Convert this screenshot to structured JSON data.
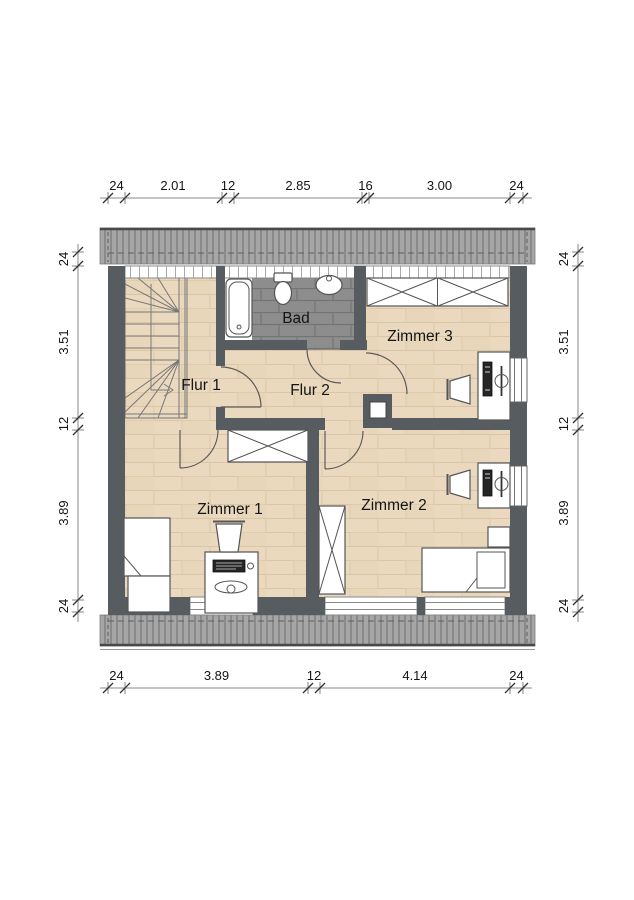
{
  "plan": {
    "rooms": [
      {
        "id": "bad",
        "label": "Bad"
      },
      {
        "id": "flur-1",
        "label": "Flur 1"
      },
      {
        "id": "flur-2",
        "label": "Flur 2"
      },
      {
        "id": "zimmer-3",
        "label": "Zimmer 3"
      },
      {
        "id": "zimmer-1",
        "label": "Zimmer 1"
      },
      {
        "id": "zimmer-2",
        "label": "Zimmer 2"
      }
    ],
    "dimensions": {
      "top": [
        "24",
        "2.01",
        "12",
        "2.85",
        "16",
        "3.00",
        "24"
      ],
      "bottom": [
        "24",
        "3.89",
        "12",
        "4.14",
        "24"
      ],
      "left": [
        "24",
        "3.51",
        "12",
        "3.89",
        "24"
      ],
      "right": [
        "24",
        "3.51",
        "12",
        "3.89",
        "24"
      ]
    }
  },
  "colors": {
    "wall": "#575c60",
    "wood_floor": "#ead9bf",
    "tile_floor": "#8d8d8d",
    "roof_band": "#a6a6a6"
  }
}
